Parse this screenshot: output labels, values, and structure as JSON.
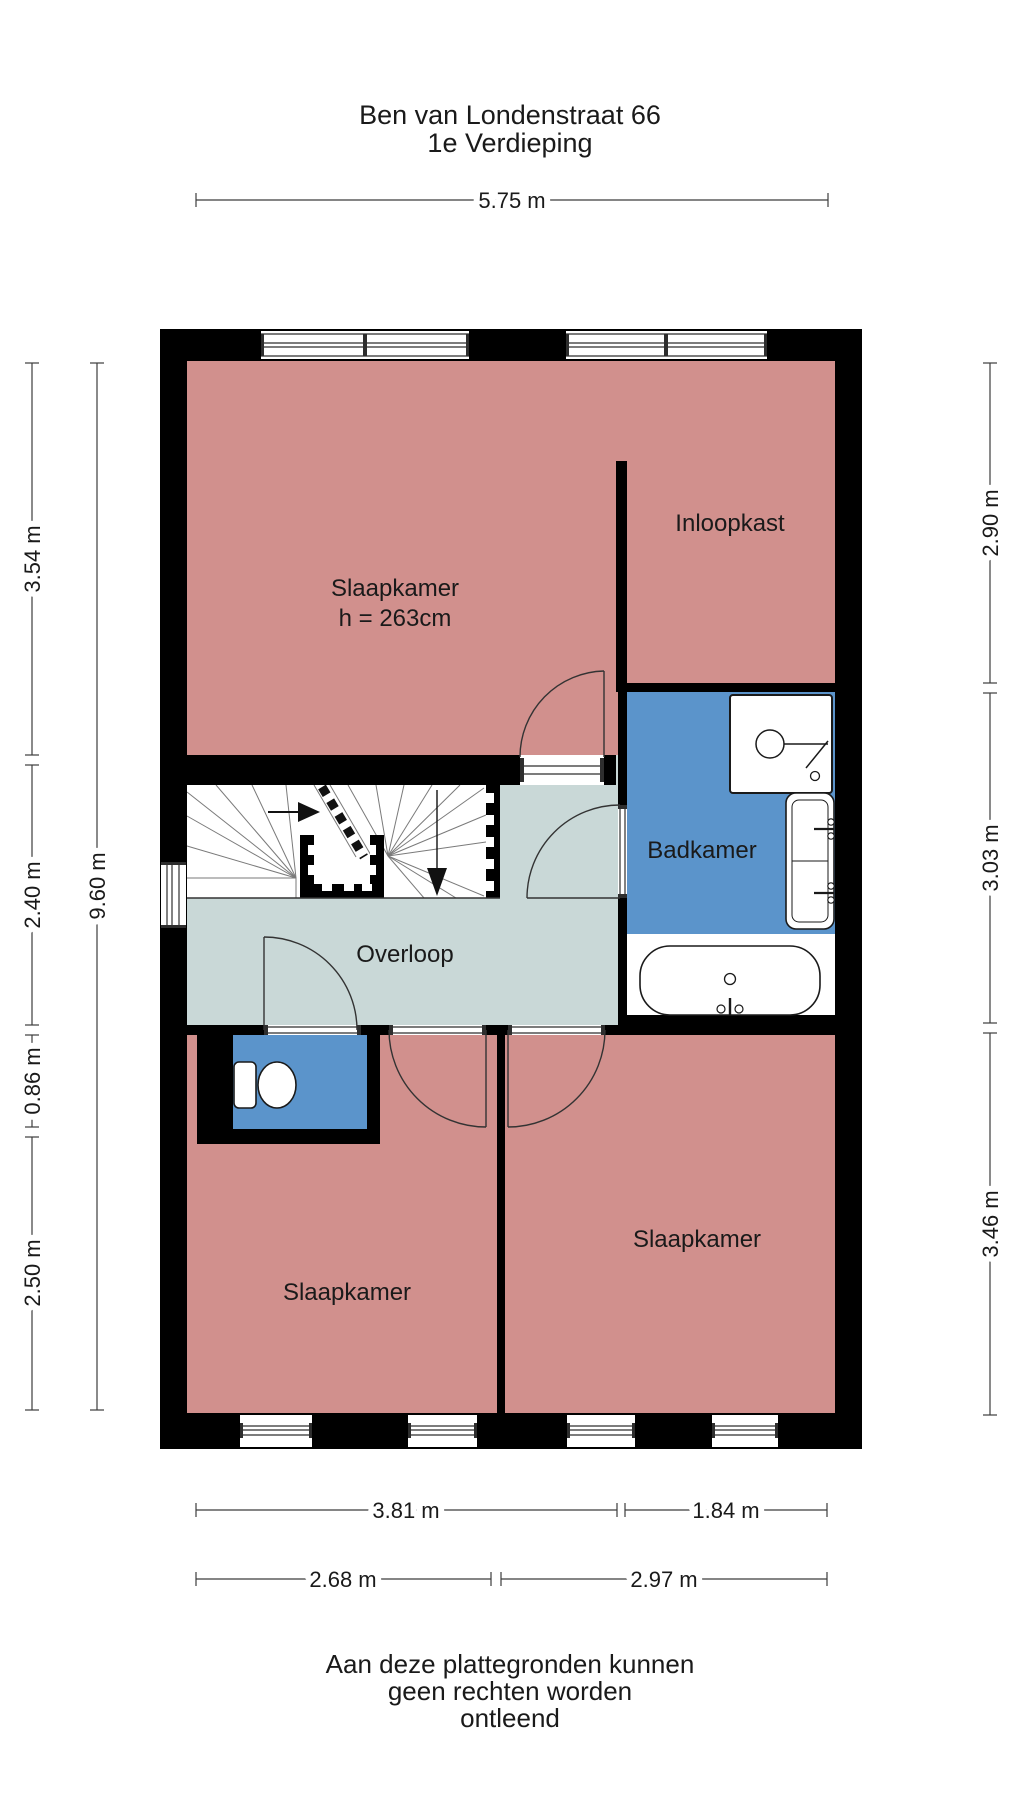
{
  "title": {
    "address": "Ben van Londenstraat 66",
    "floor": "1e Verdieping"
  },
  "rooms": {
    "bedroom_top": {
      "label": "Slaapkamer",
      "ceiling_height": "h = 263cm"
    },
    "walk_in_closet": {
      "label": "Inloopkast"
    },
    "bathroom": {
      "label": "Badkamer"
    },
    "landing": {
      "label": "Overloop"
    },
    "bedroom_bottom_left": {
      "label": "Slaapkamer"
    },
    "bedroom_bottom_right": {
      "label": "Slaapkamer"
    }
  },
  "dimensions": {
    "top_total": "5.75 m",
    "left_segments": [
      "3.54 m",
      "2.40 m",
      "0.86 m",
      "2.50 m"
    ],
    "left_total": "9.60 m",
    "right_segments": [
      "2.90 m",
      "3.03 m",
      "3.46 m"
    ],
    "bottom_row_1": [
      "3.81 m",
      "1.84 m"
    ],
    "bottom_row_2": [
      "2.68 m",
      "2.97 m"
    ]
  },
  "disclaimer": [
    "Aan deze plattegronden kunnen",
    "geen rechten worden",
    "ontleend"
  ],
  "colors": {
    "wall": "#000000",
    "bedroom_fill": "#D1908D",
    "wet_room_fill": "#5B94CB",
    "landing_fill": "#C9D8D7",
    "floor_fill": "#FFFFFF"
  }
}
